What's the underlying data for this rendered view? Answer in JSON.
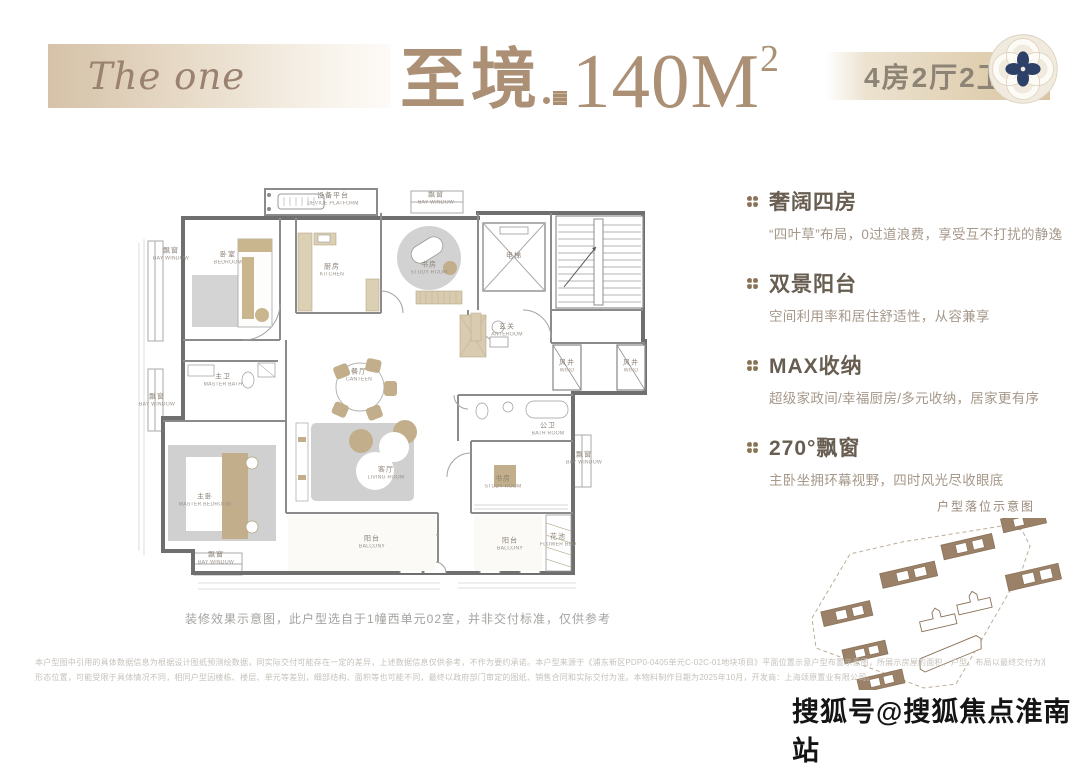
{
  "palette": {
    "brand_tan": "#ab9076",
    "banner_beige": "#d9c5a4",
    "heading_brown": "#675d50",
    "body_brown": "#a5988a",
    "plan_wall": "#6f6f6f",
    "furniture_beige": "#c2ae8a",
    "clover_blue": "#2d4068",
    "watermark_black": "#141414"
  },
  "header": {
    "brand": "The one",
    "title_zh": "至境",
    "title_area": "140M",
    "title_area_sup": "2",
    "spec": "4房2厅2卫",
    "emblem_icon": "rose-knot-clover-emblem"
  },
  "features": {
    "bullet_icon": "clover-bullet",
    "items": [
      {
        "title": "奢阔四房",
        "desc": "“四叶草”布局，0过道浪费，享受互不打扰的静逸"
      },
      {
        "title": "双景阳台",
        "desc": "空间利用率和居住舒适性，从容兼享"
      },
      {
        "title": "MAX收纳",
        "desc": "超级家政间/幸福厨房/多元收纳，居家更有序"
      },
      {
        "title": "270°飘窗",
        "desc": "主卧坐拥环幕视野，四时风光尽收眼底"
      }
    ]
  },
  "plan": {
    "caption": "装修效果示意图，此户型选自于1幢西单元02室，并非交付标准，仅供参考",
    "rooms": {
      "device_platform": {
        "zh": "设备平台",
        "en": "DEVICE PLATFORM"
      },
      "bedroom": {
        "zh": "卧室",
        "en": "BEDROOM"
      },
      "kitchen": {
        "zh": "厨房",
        "en": "KITCHEN"
      },
      "study_room": {
        "zh": "书房",
        "en": "STUDY ROOM"
      },
      "elevator": {
        "zh": "电梯",
        "en": ""
      },
      "anteroom": {
        "zh": "玄关",
        "en": "ANTEROOM"
      },
      "wind": {
        "zh": "风井",
        "en": "WIND"
      },
      "canteen": {
        "zh": "餐厅",
        "en": "CANTEEN"
      },
      "master_bath": {
        "zh": "主卫",
        "en": "MASTER BATH"
      },
      "master_bedroom": {
        "zh": "主卧",
        "en": "MASTER BEDROOM"
      },
      "living_room": {
        "zh": "客厅",
        "en": "LIVING ROOM"
      },
      "balcony": {
        "zh": "阳台",
        "en": "BALCONY"
      },
      "bath_room": {
        "zh": "公卫",
        "en": "BATH ROOM"
      },
      "flower_bed": {
        "zh": "花池",
        "en": "FLOWER BED"
      },
      "bay_window": {
        "zh": "飘窗",
        "en": "BAY WINDOW"
      }
    }
  },
  "siteplan": {
    "label": "户型落位示意图"
  },
  "footer": {
    "disclaimer_line1": "本户型图中引用的具体数据信息为根据设计图纸预测绘数据，同实际交付可能存在一定的差异，上述数据信息仅供参考，不作为要约承诺。本户型来源于《浦东新区PDP0-0405单元C-02C-01地块项目》平面位置示意户型布置示意图，所展示房屋的面积、户型、布局以最终交付为准，不同户型的面积尺寸、功能布局、空间分割、门窗/管井等",
    "disclaimer_line2": "形态位置，可能受限于具体情况不同，相同户型因楼栋、楼层、单元等差别，细部结构、面积等也可能不同，最终以政府部门审定的图纸、销售合同和实际交付为准。本物料制作日期为2025年10月，开发商：上海颂原置业有限公司。",
    "watermark": "搜狐号@搜狐焦点淮南站"
  }
}
